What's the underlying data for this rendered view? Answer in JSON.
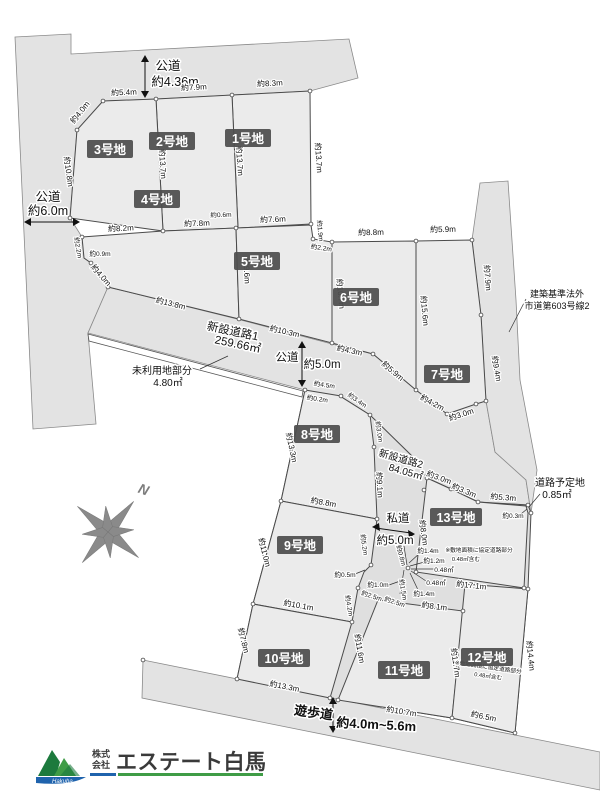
{
  "map": {
    "roads": {
      "top": {
        "name": "公道",
        "width": "約4.36m"
      },
      "left": {
        "name": "公道",
        "width": "約6.0m"
      },
      "center": {
        "name": "公道",
        "width": "約5.0m"
      },
      "shinsetsu1": {
        "name": "新設道路1",
        "area": "259.66㎡"
      },
      "shinsetsu2": {
        "name": "新設道路2",
        "area": "84.05㎡"
      },
      "unused": {
        "name": "未利用地部分",
        "area": "4.80㎡"
      },
      "private": {
        "name": "私道",
        "width": "約5.0m"
      },
      "planned": {
        "name": "道路予定地",
        "area": "0.85㎡"
      },
      "promenade": {
        "name": "遊歩道",
        "width": "約4.0m~5.6m"
      },
      "city_road_note1": "建築基準法外",
      "city_road_note2": "市道第603号線2"
    },
    "lots": {
      "lot1": {
        "label": "1号地"
      },
      "lot2": {
        "label": "2号地"
      },
      "lot3": {
        "label": "3号地"
      },
      "lot4": {
        "label": "4号地"
      },
      "lot5": {
        "label": "5号地"
      },
      "lot6": {
        "label": "6号地"
      },
      "lot7": {
        "label": "7号地"
      },
      "lot8": {
        "label": "8号地"
      },
      "lot9": {
        "label": "9号地"
      },
      "lot10": {
        "label": "10号地"
      },
      "lot11": {
        "label": "11号地"
      },
      "lot12": {
        "label": "12号地"
      },
      "lot13": {
        "label": "13号地"
      }
    },
    "dims": {
      "lot3_top": "約5.4m",
      "lot2_top": "約7.9m",
      "lot1_top": "約8.3m",
      "lot3_corner": "約4.0m",
      "lot3_left": "約10.8m",
      "b32": "約13.7m",
      "b21": "約13.7m",
      "lot1_right": "約13.7m",
      "lot4_top1": "約8.2m",
      "lot4_top2": "約7.8m",
      "jog06": "約0.6m",
      "lot5_top": "約7.6m",
      "lot5_jog1": "約1.9m",
      "lot5_jog2": "約2.2m",
      "lot4_jog1": "約2.2m",
      "lot4_jog2": "約0.9m",
      "lot4_diag": "約4.0m",
      "lot4_bottom": "約13.8m",
      "b45": "約9.6m",
      "lot5_bottom": "約10.3m",
      "lot6_top": "約8.8m",
      "lot7_top": "約5.9m",
      "lot6_left": "約10.7m",
      "b67": "約15.6m",
      "lot7_right1": "約7.9m",
      "lot7_right2": "約9.4m",
      "lot6_bot1": "約4.3m",
      "lot6_bot2": "約5.9m",
      "lot7_bot1": "約4.2m",
      "lot7_bot2": "約3.0m",
      "lot8_top1": "約4.5m",
      "lot8_jog": "約0.2m",
      "lot8_top2": "約3.4m",
      "lot8_right1": "約3.0m",
      "lot8_right2": "約9.1m",
      "lot8_left": "約13.3m",
      "lot9_top": "約8.8m",
      "lot9_left": "約11.0m",
      "lot9_right": "約5.2m",
      "lot9_jog": "約0.5m",
      "lot9_right2": "約4.2m",
      "lot9_bottom": "約10.1m",
      "cl_10": "約1.0m",
      "cl_25a": "約2.5m",
      "cl_25b": "約2.5m",
      "cl_08": "約0.8m",
      "cl_15": "約1.5m",
      "cl_14a": "約1.4m",
      "cl_12": "約1.2m",
      "cl_048a": "0.48㎡",
      "cl_048b": "0.48㎡",
      "cl_14b": "約1.4m",
      "lot10_left": "約7.8m",
      "b1011": "約11.6m",
      "lot10_bottom": "約13.3m",
      "lot11_top": "約8.1m",
      "b1112": "約11.7m",
      "lot11_bottom": "約10.7m",
      "lot12_top": "約17.1m",
      "lot12_right": "約14.4m",
      "lot12_bottom": "約6.5m",
      "lot13_d1": "約3.0m",
      "lot13_d2": "約3.3m",
      "lot13_top": "約5.3m",
      "lot13_left": "約8.0m",
      "lot13_jog": "約0.3m"
    },
    "notes": {
      "kyotei_line1": "※敷地面積に協定道路部分",
      "kyotei_line2": "0.48㎡含む"
    },
    "compass": {
      "label": "N"
    },
    "logo": {
      "prefix1": "株式",
      "prefix2": "会社",
      "company": "エステート白馬",
      "script": "Hakuba"
    },
    "colors": {
      "lot_highlight": "#d9e8c2",
      "road": "#e3e3e3",
      "plot": "#ebebeb",
      "badge": "#4d4d4d",
      "logo_green": "#3f9c46",
      "logo_blue": "#1f63ad",
      "logo_text": "#3a3a3a"
    }
  }
}
